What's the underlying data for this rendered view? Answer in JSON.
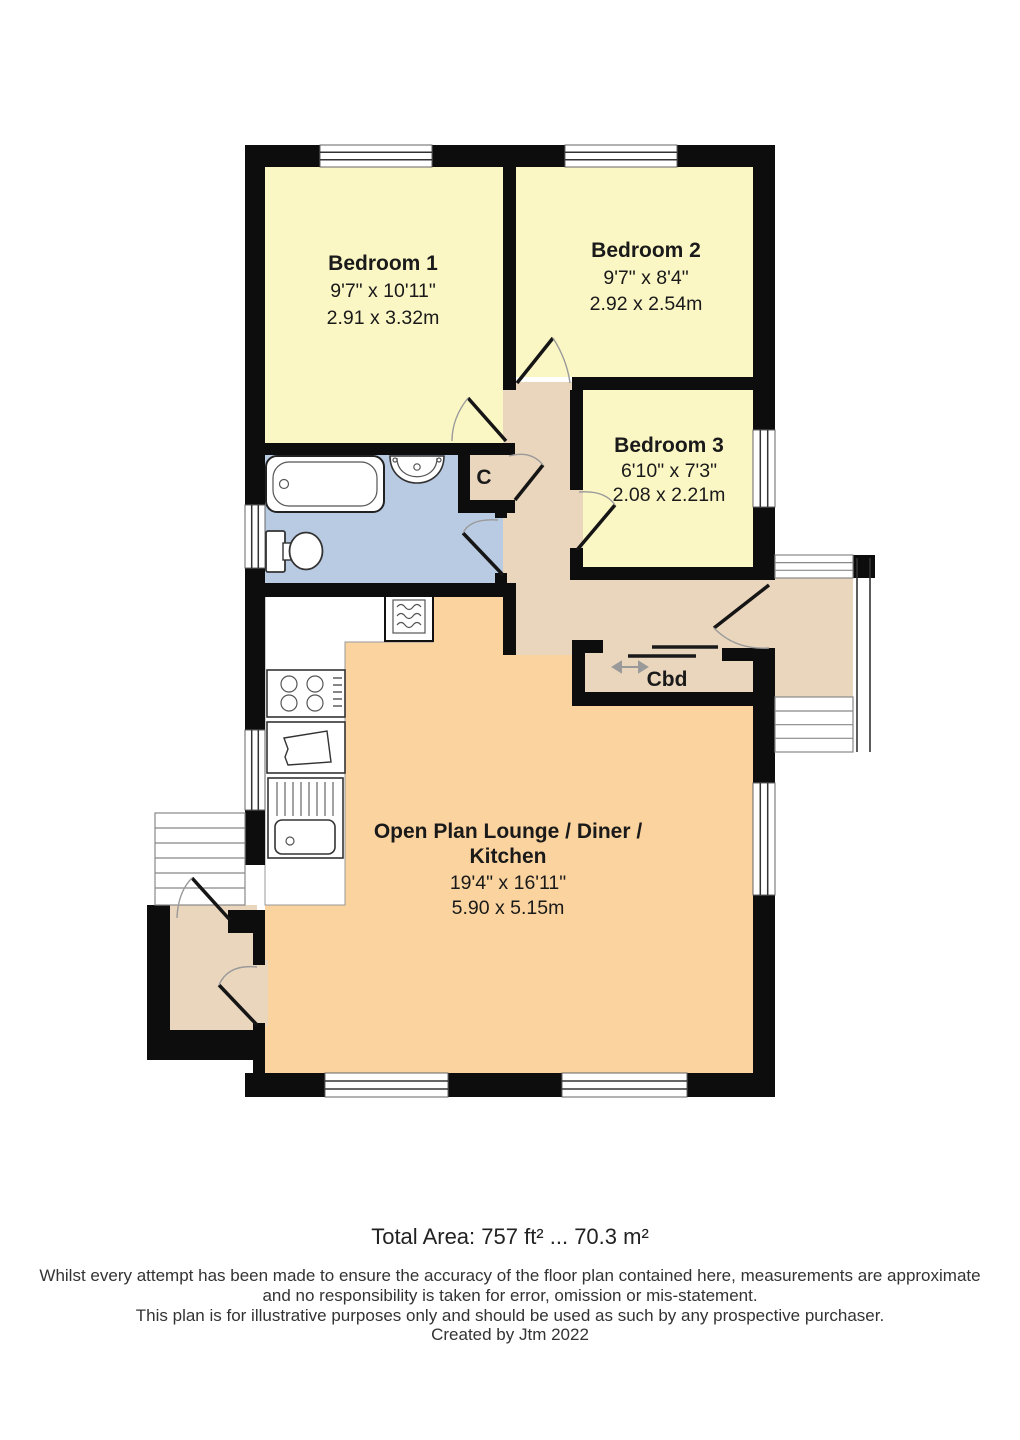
{
  "plan": {
    "colors": {
      "bedroom": "#FBF7C5",
      "bathroom": "#B9CBE3",
      "hall": "#EAD6BC",
      "lounge": "#FBD39E",
      "wall": "#0D0D0D"
    },
    "rooms": {
      "bedroom1": {
        "name": "Bedroom 1",
        "dim_ft": "9'7\" x 10'11\"",
        "dim_m": "2.91 x 3.32m"
      },
      "bedroom2": {
        "name": "Bedroom 2",
        "dim_ft": "9'7\" x 8'4\"",
        "dim_m": "2.92 x 2.54m"
      },
      "bedroom3": {
        "name": "Bedroom 3",
        "dim_ft": "6'10\" x 7'3\"",
        "dim_m": "2.08 x 2.21m"
      },
      "lounge": {
        "name_line1": "Open Plan Lounge / Diner /",
        "name_line2": "Kitchen",
        "dim_ft": "19'4\" x 16'11\"",
        "dim_m": "5.90 x 5.15m"
      },
      "cupboard_small": {
        "name": "C"
      },
      "cupboard": {
        "name": "Cbd"
      }
    }
  },
  "footer": {
    "total_area": "Total Area: 757 ft² ... 70.3 m²",
    "disclaimer_line1": "Whilst every attempt has been made to ensure the accuracy of the floor plan contained here, measurements are approximate",
    "disclaimer_line2": "and no responsibility is taken for error, omission or mis-statement.",
    "disclaimer_line3": "This plan is for illustrative purposes only and should be used as such by any prospective purchaser.",
    "credit": "Created by Jtm 2022"
  }
}
